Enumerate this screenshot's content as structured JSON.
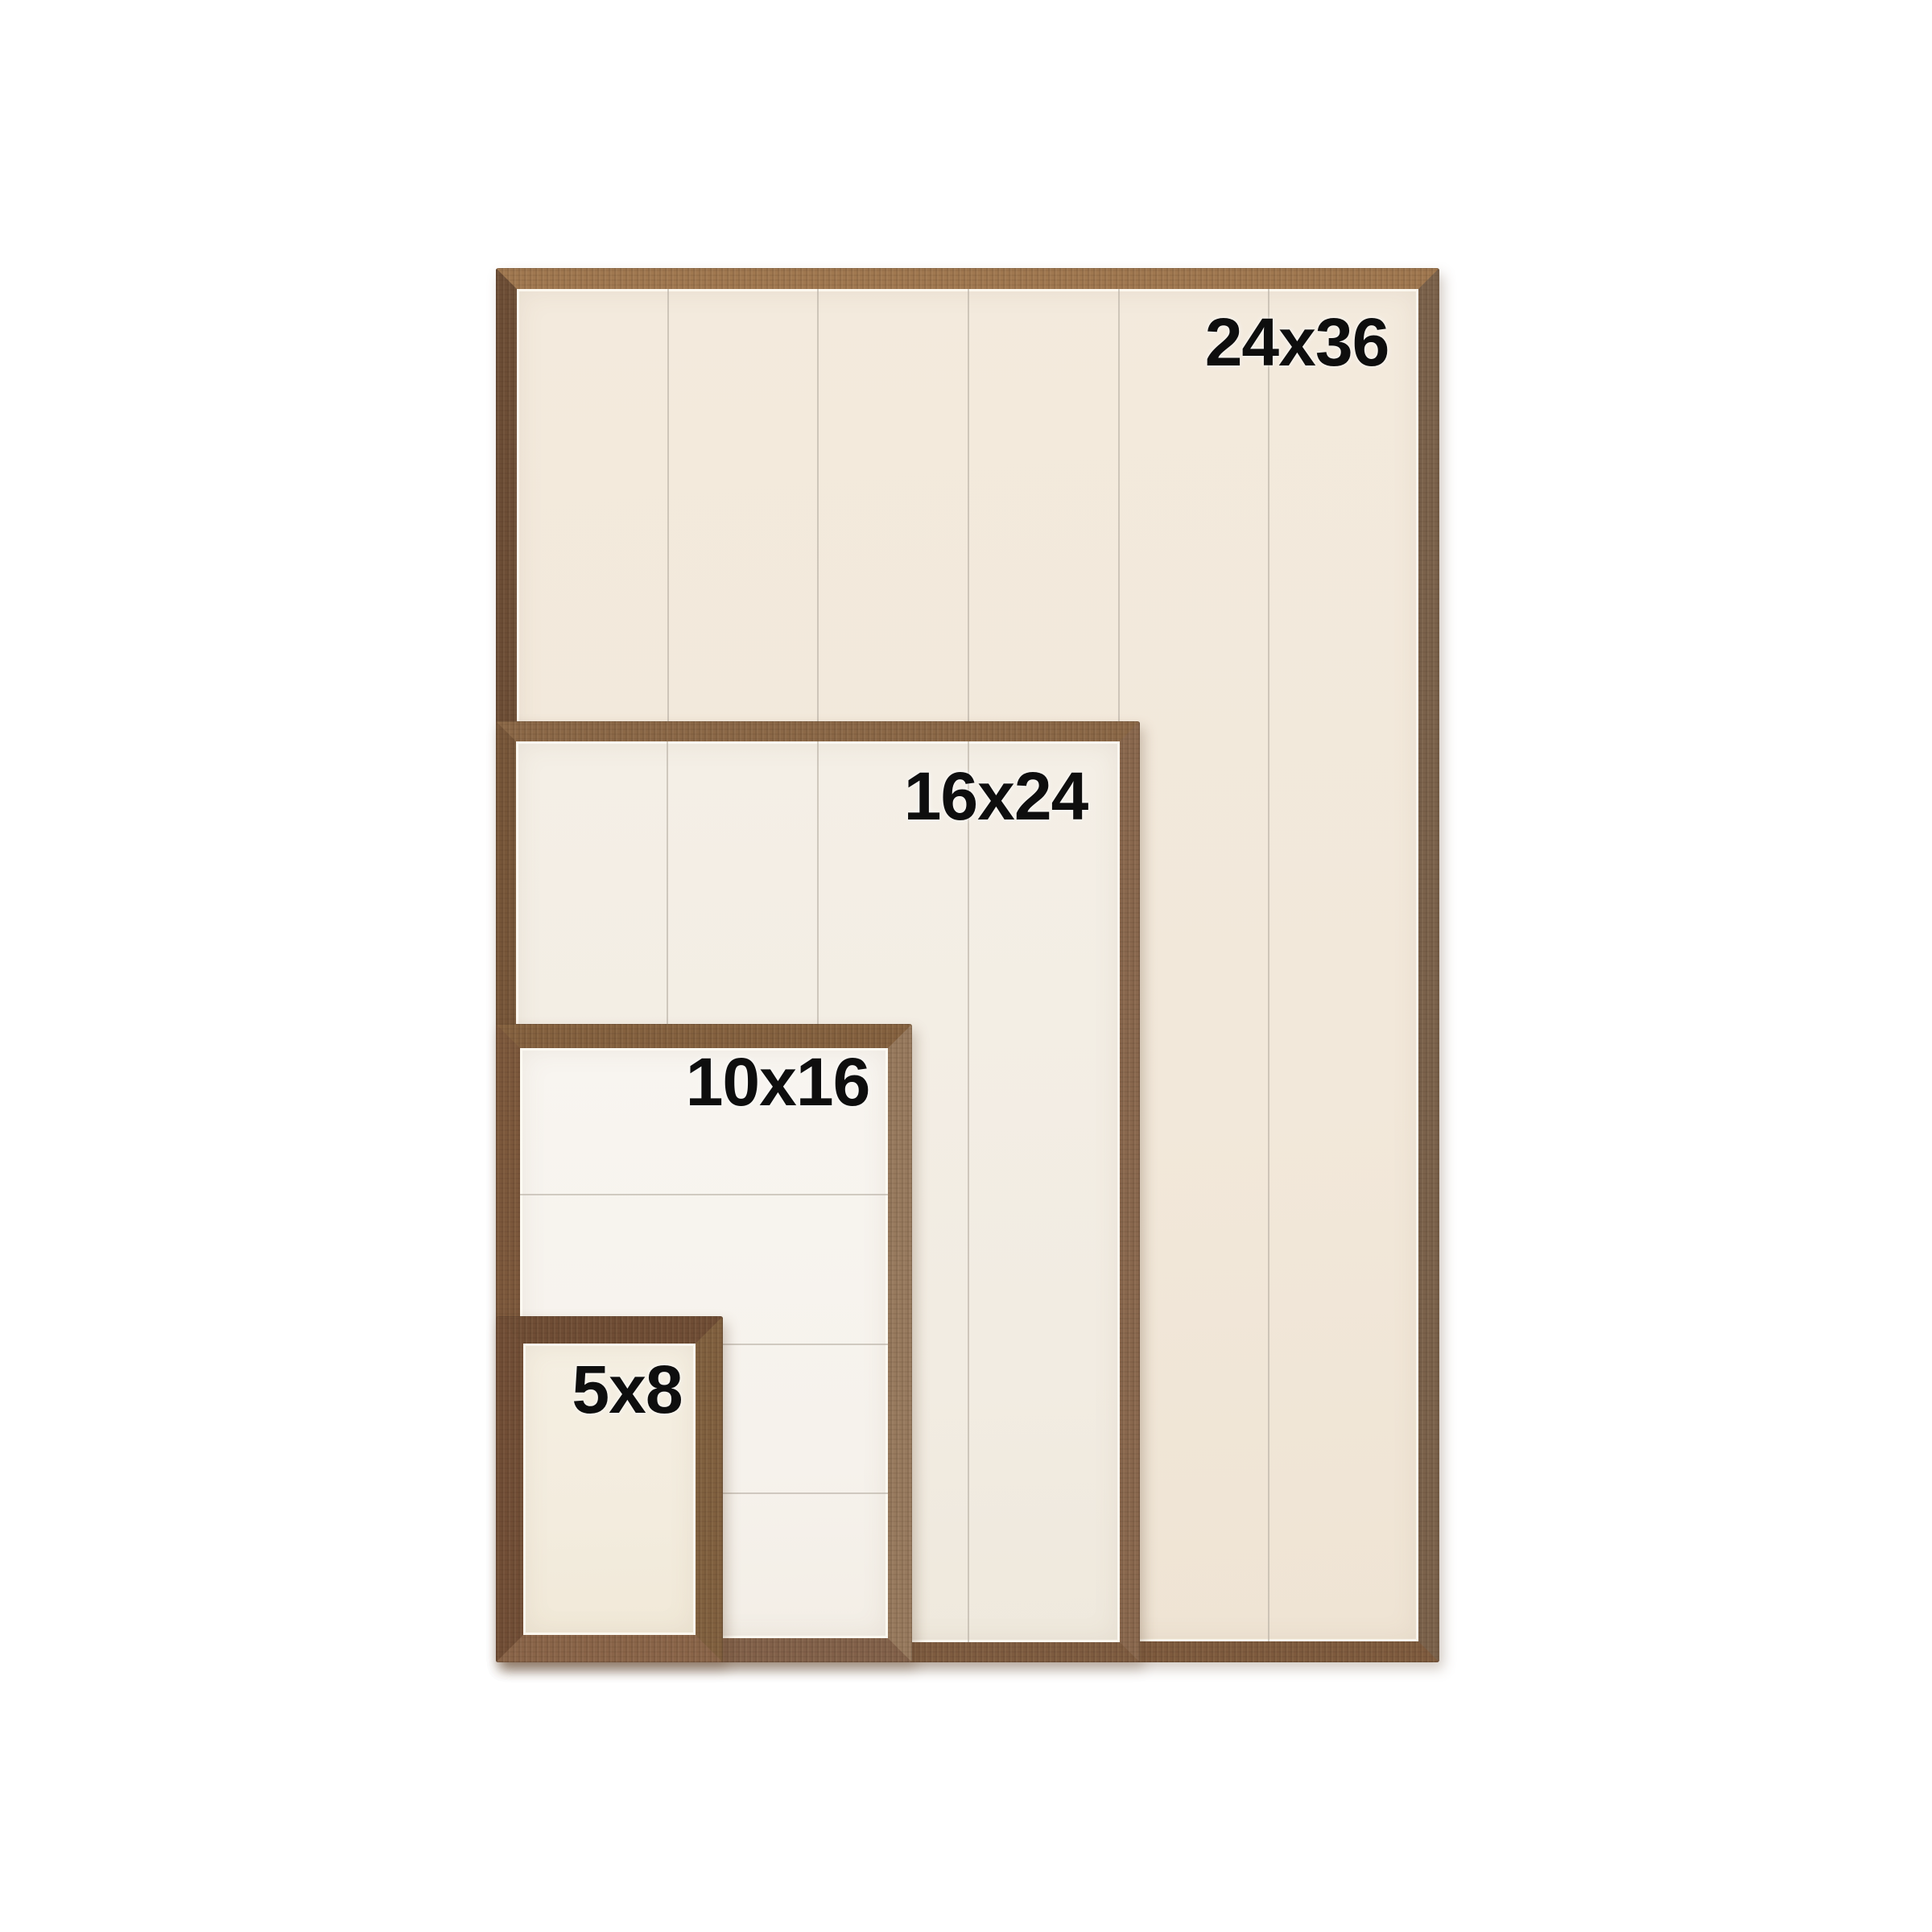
{
  "image": {
    "kind": "product-size-comparison",
    "background_color": "#ffffff"
  },
  "sizes": [
    {
      "label": "24x36"
    },
    {
      "label": "16x24"
    },
    {
      "label": "10x16"
    },
    {
      "label": "5x8"
    }
  ],
  "colors": {
    "label_text": "#0e0e0e",
    "wood_brown_light": "#a07850",
    "wood_brown_mid": "#7e5c40",
    "wood_brown_dark": "#6d4e36",
    "panel_cream_large": "#f2e8da",
    "panel_cream_small": "#f3ecde",
    "panel_white": "#f7f4ef",
    "plank_seam": "#b5aea2"
  }
}
